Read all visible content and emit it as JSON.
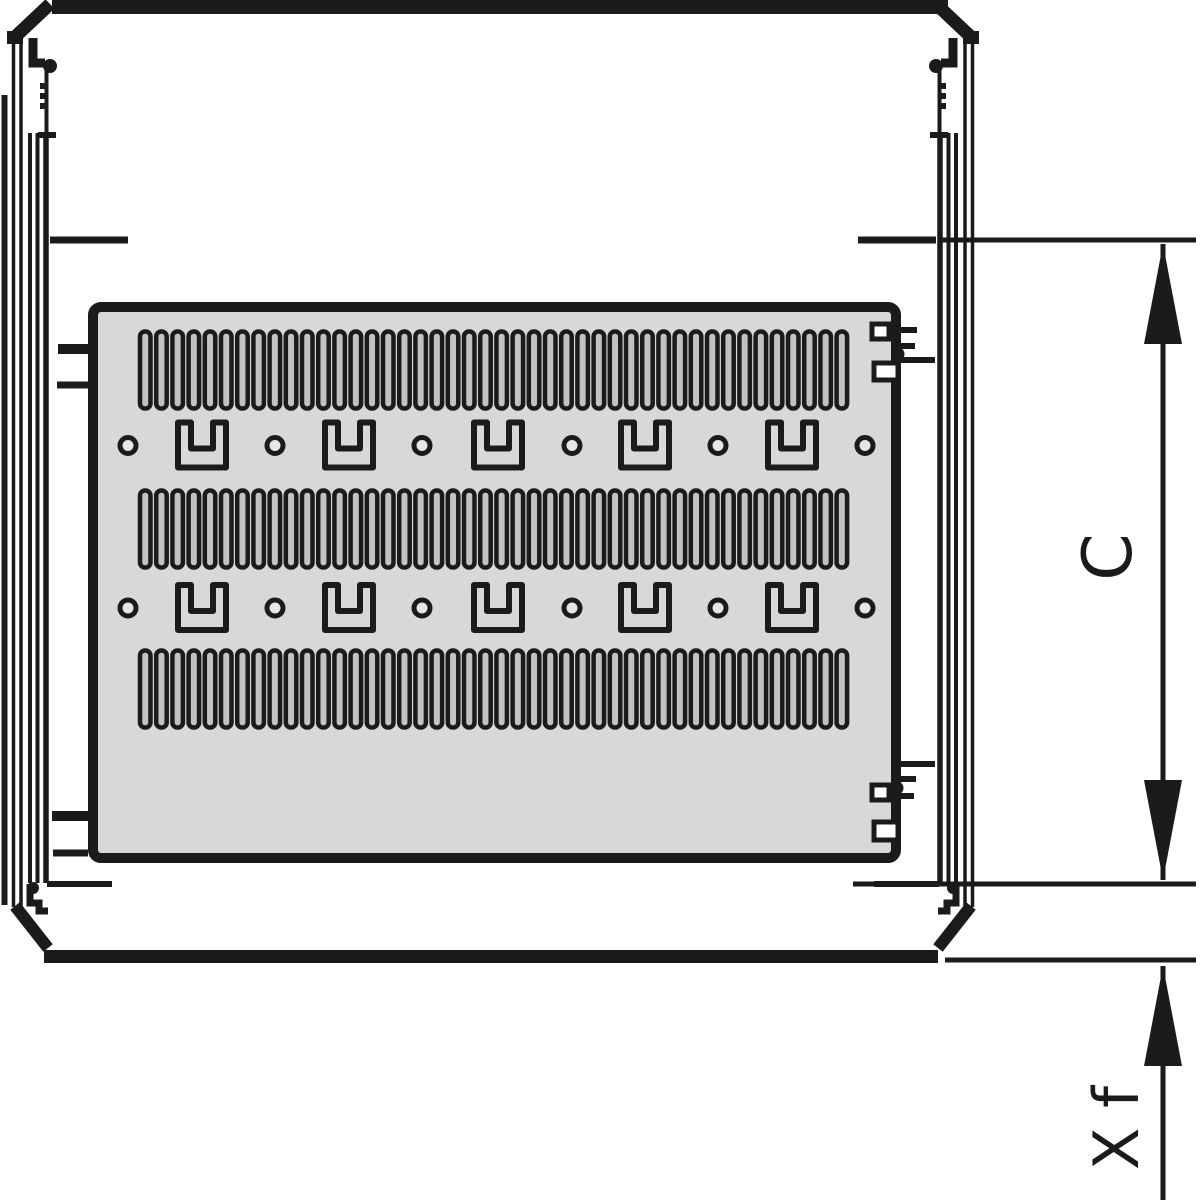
{
  "drawing": {
    "type": "technical-drawing",
    "subject": "cabinet-cross-section-with-perforated-shelf",
    "colors": {
      "line": "#1b1b1b",
      "panel_fill": "#d8d8d8",
      "slot_fill": "#c2c2c2",
      "hole_fill": "#e6e6e6",
      "background": "#ffffff"
    },
    "labels": {
      "dim_c": "C",
      "dim_xf": "X f"
    },
    "shelf": {
      "slot_rows": [
        331.5,
        490.5,
        650.5
      ],
      "slot_row_height": 77,
      "slot_start_x": 140,
      "slot_pitch": 16.2,
      "slot_width": 10.5,
      "slots_per_row": 44,
      "bracket_rows": [
        445.5,
        608
      ],
      "hole_xs": [
        128,
        275,
        422,
        572,
        718,
        865
      ],
      "bracket_xs": [
        202,
        349,
        498,
        645,
        792
      ]
    },
    "dimensions": [
      {
        "id": "c",
        "label": "C",
        "x": 1163,
        "from_y": 244,
        "to_y": 880,
        "start_arrow": true,
        "end_arrow": true,
        "label_x": 1131,
        "label_y": 557,
        "font_size": 68
      },
      {
        "id": "xf",
        "label": "X f",
        "x": 1163,
        "from_y": 966,
        "to_y": 1206,
        "start_arrow": true,
        "end_arrow": false,
        "label_x": 1138,
        "label_y": 1128,
        "font_size": 62
      }
    ],
    "arrow": {
      "length": 100,
      "half_width": 19
    }
  }
}
